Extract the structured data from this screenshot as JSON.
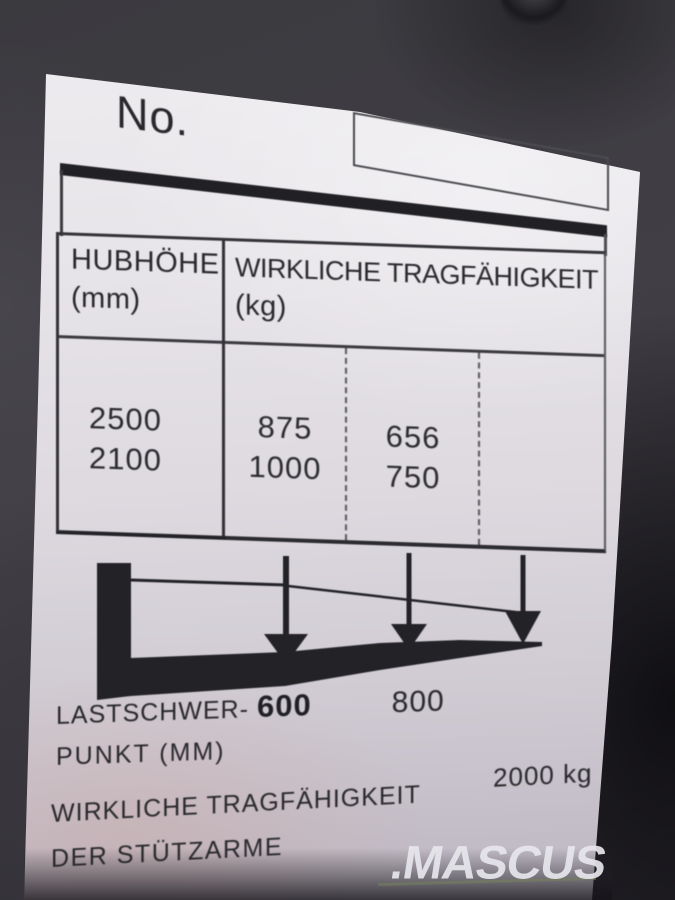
{
  "plate": {
    "no_label": "No.",
    "table": {
      "col1_header": "HUBHÖHE",
      "col1_unit": "(mm)",
      "col2_header": "WIRKLICHE TRAGFÄHIGKEIT",
      "col2_unit": "(kg)",
      "lift_heights": [
        "2500",
        "2100"
      ],
      "capacity_at_600": [
        "875",
        "1000"
      ],
      "capacity_at_800": [
        "656",
        "750"
      ]
    },
    "load_center": {
      "label_top": "LASTSCHWER-",
      "label_bottom": "PUNKT (MM)",
      "value_1": "600",
      "value_2": "800"
    },
    "support_arms": {
      "label_top": "WIRKLICHE TRAGFÄHIGKEIT",
      "label_bottom": "DER STÜTZARME",
      "value": "2000 kg"
    }
  },
  "watermark": {
    "text": ".MASCUS"
  },
  "colors": {
    "plate_ink": "#28282c",
    "paper": "#e7e4e9",
    "panel": "#3b3a3f"
  }
}
